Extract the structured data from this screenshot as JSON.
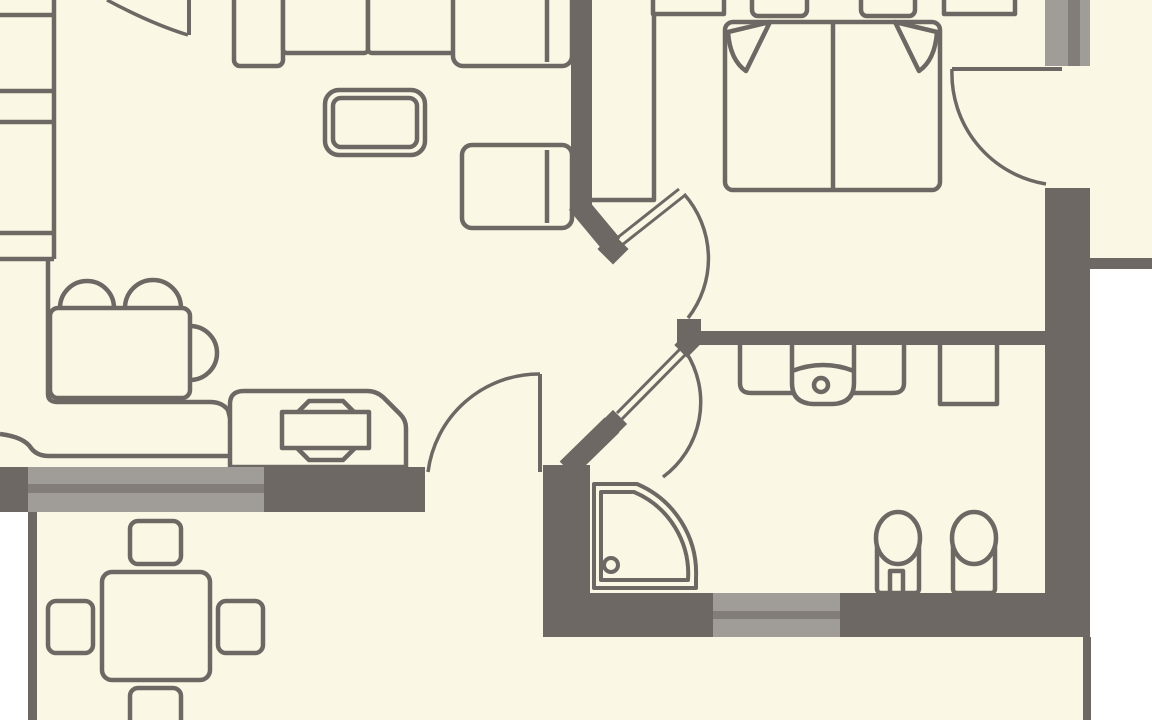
{
  "document": {
    "kind": "apartment-floor-plan",
    "visible_text": "none"
  },
  "palette": {
    "floor": "#faf8e5",
    "wall": "#6e6864",
    "outline": "#6e6864",
    "window_glass": "#a09c97",
    "window_frame": "#827d79",
    "outside": "#ffffff"
  },
  "rooms": [
    {
      "name": "living-room",
      "furniture": [
        "shelf-unit",
        "corner-sofa",
        "armchair",
        "coffee-table",
        "desk-with-three-chairs",
        "kitchen-counter",
        "media-console"
      ]
    },
    {
      "name": "bedroom",
      "furniture": [
        "wardrobe",
        "double-bed",
        "pillows",
        "nightstand-left",
        "nightstand-right"
      ]
    },
    {
      "name": "hallway",
      "furniture": []
    },
    {
      "name": "bathroom",
      "furniture": [
        "corner-shower",
        "toilet",
        "bidet",
        "vanity-with-sink",
        "cabinet"
      ]
    },
    {
      "name": "terrace",
      "furniture": [
        "outdoor-table",
        "outdoor-chairs"
      ]
    }
  ],
  "openings": {
    "doors": [
      "entrance-door",
      "terrace-door",
      "bedroom-hall-door",
      "bathroom-hall-door",
      "bedroom-side-door"
    ],
    "windows": [
      "living-room-window",
      "bathroom-window",
      "bedroom-window"
    ]
  }
}
